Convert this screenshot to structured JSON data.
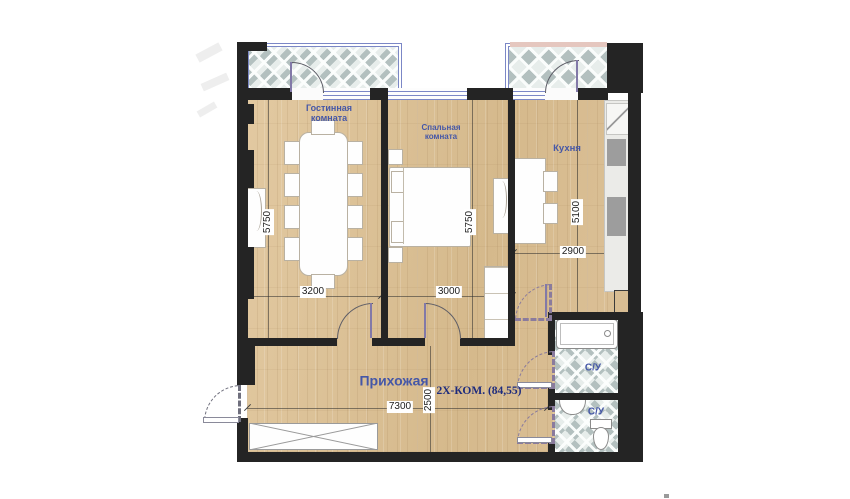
{
  "plan": {
    "apartment_label": "2Х-КОМ. (84,55)",
    "rooms": {
      "living": {
        "label": "Гостинная комната",
        "width": "3200",
        "height": "5750"
      },
      "bedroom": {
        "label": "Спальная комната",
        "width": "3000",
        "height": "5750"
      },
      "kitchen": {
        "label": "Кухня",
        "width": "2900",
        "height": "5100"
      },
      "hallway": {
        "label": "Прихожая",
        "width": "7300",
        "height": "2500"
      },
      "bathroom_upper": {
        "label": "С/У"
      },
      "bathroom_lower": {
        "label": "С/У"
      }
    },
    "colors": {
      "wall": "#242424",
      "wood_floor": "#dcc19a",
      "tile_diamond": "#b3c0bf",
      "room_label_blue": "#4557a7",
      "title_navy": "#1d2b7d",
      "glazing_blue": "#7b87c6"
    }
  }
}
